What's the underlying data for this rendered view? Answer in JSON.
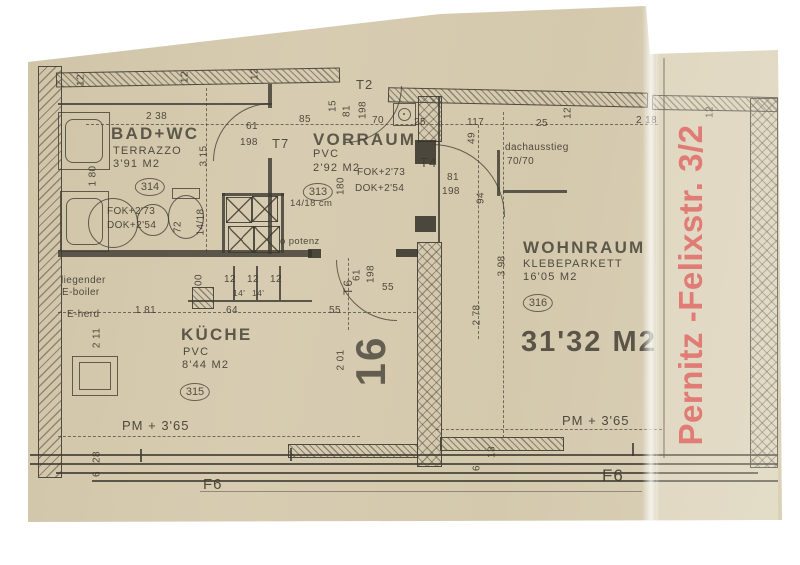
{
  "colors": {
    "paper": "#d6cbb0",
    "ink": "#45413a",
    "red_stamp": "#d64040"
  },
  "red_stamp": "Pernitz -Felixstr. 3/2",
  "number_stamp": "16",
  "total_area": "31'32 M2",
  "rooms": {
    "bad": {
      "name": "BAD+WC",
      "floor": "TERRAZZO",
      "area": "3'91 M2",
      "tag": "314",
      "fok": "FOK+2'73",
      "dok": "DOK+2'54"
    },
    "vorraum": {
      "name": "VORRAUM",
      "floor": "PVC",
      "area": "2'92 M2",
      "tag": "313",
      "fok": "FOK+2'73",
      "dok": "DOK+2'54"
    },
    "wohnraum": {
      "name": "WOHNRAUM",
      "floor": "KLEBEPARKETT",
      "area": "16'05 M2",
      "tag": "316"
    },
    "kueche": {
      "name": "KÜCHE",
      "floor": "PVC",
      "area": "8'44 M2",
      "tag": "315"
    }
  },
  "doors": {
    "t2": "T2",
    "t4": "T4",
    "t6": "T6",
    "t7": "T7",
    "f6_right": "F6",
    "f6_left": "F6"
  },
  "annotations": {
    "dachausstieg_line1": "dachausstieg",
    "dachausstieg_line2": "70/70",
    "boiler_line1": "liegender",
    "boiler_line2": "E-boiler",
    "eherd": "E-herd",
    "duct": "14/18 cm",
    "potenz": "o potenz",
    "pm_left": "PM + 3'65",
    "pm_right": "PM + 3'65"
  },
  "dims": [
    "2 38",
    "61",
    "198",
    "3 15",
    "1 80",
    "12",
    "12",
    "12",
    "85",
    "15",
    "81",
    "198",
    "70",
    "25",
    "117",
    "12",
    "2 18",
    "12",
    "49",
    "94",
    "81",
    "198",
    "180",
    "72",
    "14/18",
    "00",
    "12",
    "12",
    "12",
    "14'",
    "14'",
    "1 81",
    "64",
    "55",
    "55",
    "61",
    "198",
    "2 78",
    "3 98",
    "2 11",
    "2 01",
    "28",
    "6",
    "13",
    "6",
    "25"
  ]
}
